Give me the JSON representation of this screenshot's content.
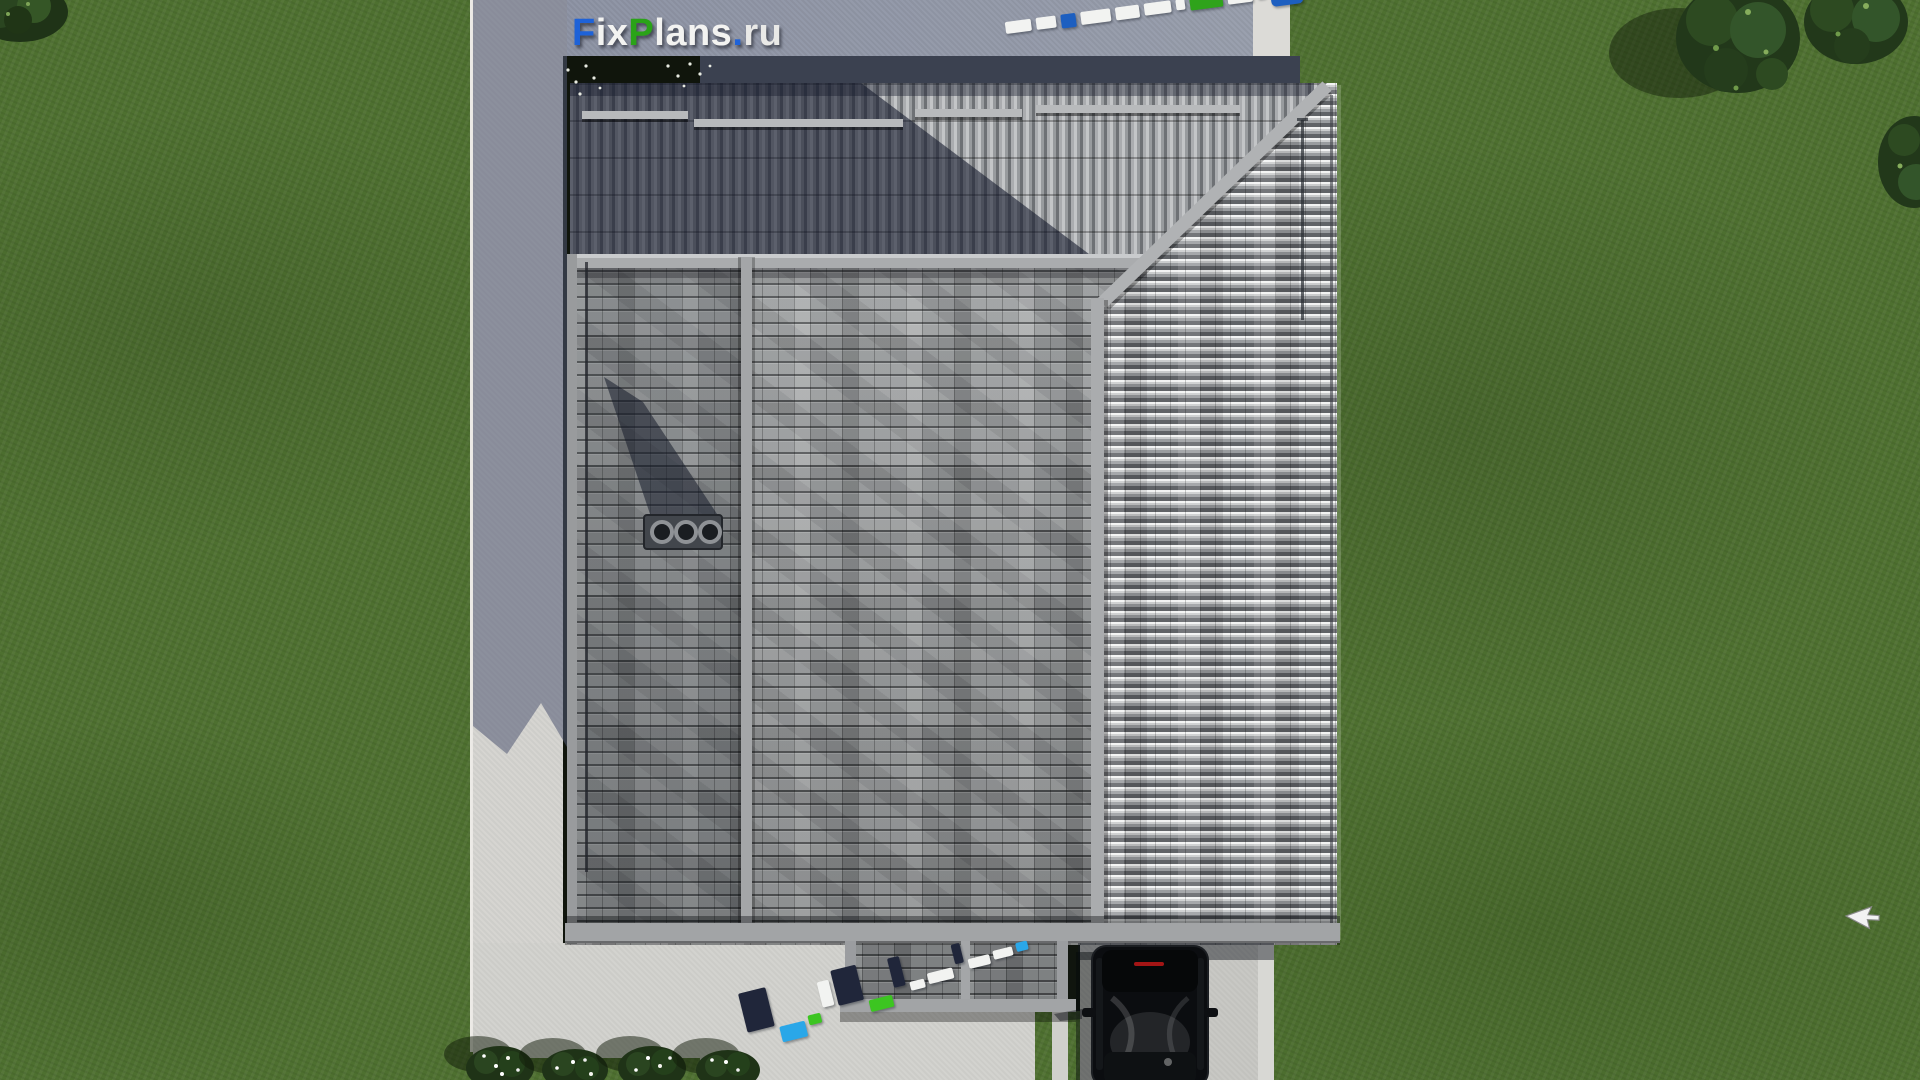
{
  "site": {
    "name": "FixPlans.ru"
  },
  "logo": {
    "parts": [
      {
        "text": "F",
        "color": "#1e62d8"
      },
      {
        "text": "ix",
        "color": "#f3f3f1"
      },
      {
        "text": "P",
        "color": "#2aa318"
      },
      {
        "text": "lans",
        "color": "#f3f3f1"
      },
      {
        "text": ".",
        "color": "#1e62d8"
      },
      {
        "text": "ru",
        "color": "#e9e9e7"
      }
    ]
  },
  "watermarks": {
    "top_right": {
      "description": "3D FixPlans.ru text object lying on pavement, seen from above",
      "angle_deg": -7.5,
      "blocks": [
        {
          "c": "#f2f3f1",
          "w": 26,
          "h": 12
        },
        {
          "c": "#f2f3f1",
          "w": 20,
          "h": 12
        },
        {
          "c": "#1d5fc0",
          "w": 15,
          "h": 14
        },
        {
          "c": "#f2f3f1",
          "w": 30,
          "h": 13
        },
        {
          "c": "#f2f3f1",
          "w": 24,
          "h": 13
        },
        {
          "c": "#f2f3f1",
          "w": 27,
          "h": 12
        },
        {
          "c": "#f2f3f1",
          "w": 9,
          "h": 11
        },
        {
          "c": "#2fa31b",
          "w": 33,
          "h": 13
        },
        {
          "c": "#f2f3f1",
          "w": 25,
          "h": 12
        },
        {
          "c": "#2fa31b",
          "w": 8,
          "h": 10
        },
        {
          "c": "#1d5fc0",
          "w": 32,
          "h": 20,
          "r": 5
        }
      ]
    },
    "bottom_center": {
      "description": "standing 3D FixPlans.ru letters near porch, seen from above with shadows",
      "angle_deg": -14,
      "blocks": [
        {
          "c": "#20263a",
          "w": 28,
          "h": 40,
          "dy": 0
        },
        {
          "c": "#2aa7e8",
          "w": 26,
          "h": 16,
          "dy": 42
        },
        {
          "c": "#3cc521",
          "w": 13,
          "h": 10,
          "dy": 38
        },
        {
          "c": "#f2f3f1",
          "w": 12,
          "h": 26,
          "dy": 8
        },
        {
          "c": "#20263a",
          "w": 26,
          "h": 36,
          "dy": 0
        },
        {
          "c": "#3cc521",
          "w": 24,
          "h": 12,
          "dy": 38
        },
        {
          "c": "#20263a",
          "w": 12,
          "h": 30,
          "dy": 2
        },
        {
          "c": "#f2f3f1",
          "w": 15,
          "h": 9,
          "dy": 30
        },
        {
          "c": "#f2f3f1",
          "w": 26,
          "h": 11,
          "dy": 26
        },
        {
          "c": "#20263a",
          "w": 9,
          "h": 20,
          "dy": 4
        },
        {
          "c": "#f2f3f1",
          "w": 22,
          "h": 10,
          "dy": 22
        },
        {
          "c": "#f2f3f1",
          "w": 20,
          "h": 9,
          "dy": 20
        },
        {
          "c": "#2aa7e8",
          "w": 12,
          "h": 9,
          "dy": 18
        }
      ]
    }
  },
  "scene": {
    "type": "aerial top-down 3D render of a house",
    "grass_color": "#4e7030",
    "pavement_color": "#d6d5d1",
    "pavement_shadow_color": "#9097a8",
    "roof_tile_light": "#c6c8ca",
    "roof_tile_dark": "#6b6e72",
    "roof_shadow_color": "#2e3547",
    "ridge_color": "#aaacae",
    "chimney_color": "#42464c",
    "car_color": "#0b0d10",
    "car_brake_light": "#a31515",
    "cursor_color": "#f2f2f2",
    "objects": [
      "main-roof",
      "hip-roof-slope",
      "porch-roof",
      "chimney-vents",
      "black-car",
      "driveway",
      "walkway",
      "flower-bushes",
      "trees",
      "mouse-cursor"
    ]
  }
}
